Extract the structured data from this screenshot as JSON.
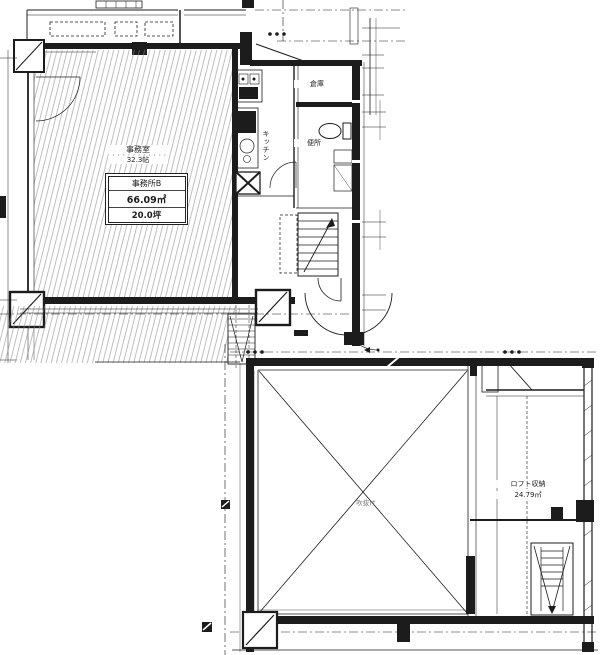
{
  "colors": {
    "ink": "#1c1c1c",
    "hatch": "#8a8a8a",
    "background": "#ffffff"
  },
  "upper_plan": {
    "room": {
      "name": "事務室",
      "size": "32.3帖"
    },
    "unit_box": {
      "name": "事務所B",
      "area_sqm": "66.09㎡",
      "area_tsubo": "20.0坪"
    },
    "storage_label": "倉庫",
    "kitchen_label": "キッチン",
    "toilet_label": "便所"
  },
  "lower_plan": {
    "void_label": "吹抜け",
    "loft": {
      "name": "ロフト収納",
      "area": "24.79㎡"
    }
  }
}
